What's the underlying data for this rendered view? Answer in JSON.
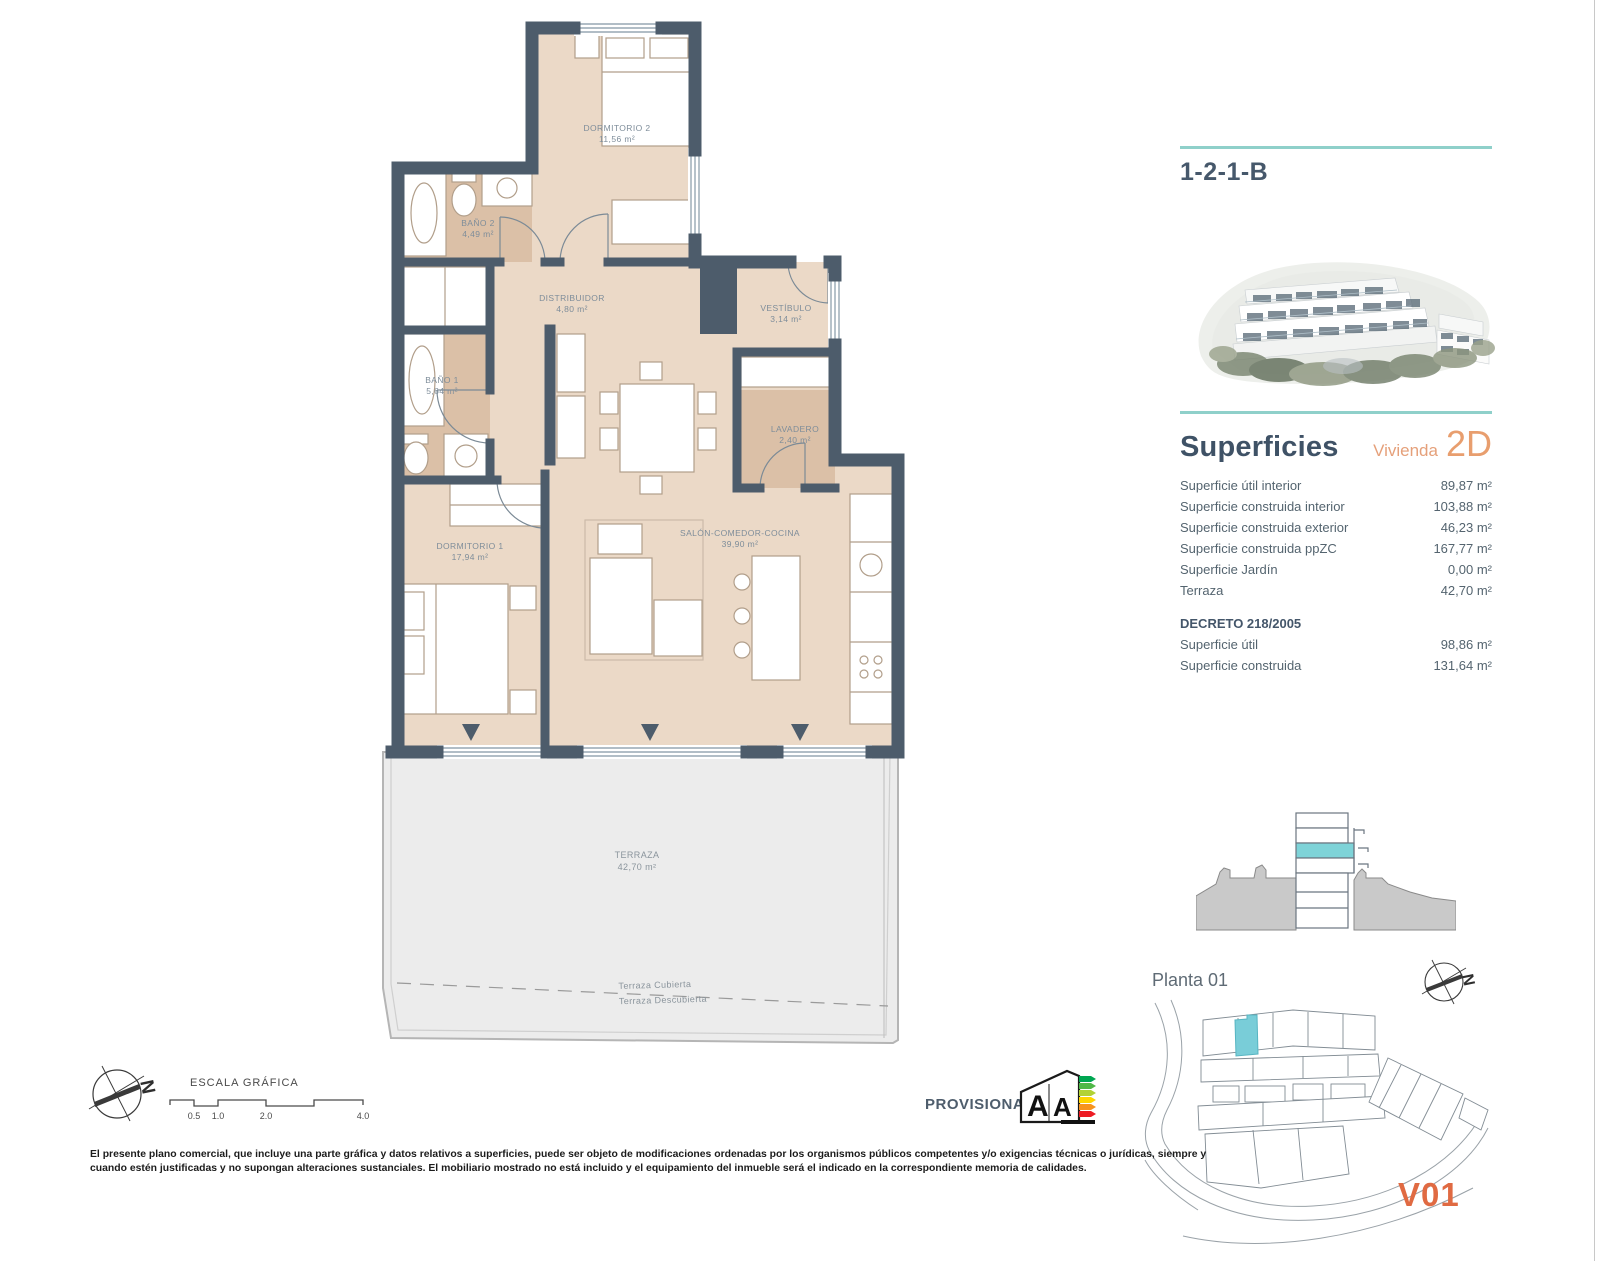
{
  "page": {
    "unit_code": "1-2-1-B"
  },
  "superficies": {
    "heading": "Superficies",
    "vivienda_label": "Vivienda",
    "vivienda_code": "2D",
    "rows": [
      {
        "label": "Superficie útil interior",
        "value": "89,87 m²"
      },
      {
        "label": "Superficie construida interior",
        "value": "103,88 m²"
      },
      {
        "label": "Superficie construida exterior",
        "value": "46,23 m²"
      },
      {
        "label": "Superficie construida ppZC",
        "value": "167,77 m²"
      },
      {
        "label": "Superficie Jardín",
        "value": "0,00 m²"
      },
      {
        "label": "Terraza",
        "value": "42,70 m²"
      }
    ],
    "decreto": {
      "heading": "DECRETO 218/2005",
      "rows": [
        {
          "label": "Superficie útil",
          "value": "98,86 m²"
        },
        {
          "label": "Superficie construida",
          "value": "131,64 m²"
        }
      ]
    }
  },
  "floorplan": {
    "rooms": {
      "dormitorio2": {
        "name": "DORMITORIO 2",
        "area": "11,56 m²"
      },
      "bano2": {
        "name": "BAÑO 2",
        "area": "4,49 m²"
      },
      "distribuidor": {
        "name": "DISTRIBUIDOR",
        "area": "4,80 m²"
      },
      "vestibulo": {
        "name": "VESTÍBULO",
        "area": "3,14 m²"
      },
      "bano1": {
        "name": "BAÑO 1",
        "area": "5,64 m²"
      },
      "lavadero": {
        "name": "LAVADERO",
        "area": "2,40 m²"
      },
      "dormitorio1": {
        "name": "DORMITORIO 1",
        "area": "17,94 m²"
      },
      "salon": {
        "name": "SALÓN-COMEDOR-COCINA",
        "area": "39,90 m²"
      },
      "terraza": {
        "name": "TERRAZA",
        "area": "42,70 m²"
      }
    },
    "terrace_line": {
      "above": "Terraza Cubierta",
      "below": "Terraza Descubierta"
    }
  },
  "scale_bar": {
    "title": "ESCALA GRÁFICA",
    "ticks": [
      "0.5",
      "1.0",
      "2.0",
      "4.0"
    ]
  },
  "compass": {
    "letter": "N"
  },
  "site": {
    "floor_label": "Planta 01",
    "block_code": "V01"
  },
  "footer": {
    "provisional": "PROVISIONAL",
    "energy": {
      "left": "A",
      "right": "A"
    },
    "disclaimer_line1": "El presente plano comercial, que incluye una parte gráfica y datos relativos a superficies, puede ser objeto de modificaciones ordenadas por los organismos públicos competentes y/o exigencias técnicas o jurídicas, siempre y",
    "disclaimer_line2": "cuando estén justificadas y no supongan alteraciones sustanciales. El mobiliario mostrado no está incluido y el equipamiento del inmueble será el indicado en la correspondiente memoria de calidades."
  },
  "colors": {
    "accent_teal": "#8fd0ca",
    "accent_orange": "#e5a07a",
    "orange_strong": "#e06a42",
    "wall": "#4d5c6b",
    "interior": "#ebd9c7",
    "wet_room": "#dbc0a7",
    "terrace": "#ececec",
    "highlight_teal": "#7ed3d8"
  }
}
